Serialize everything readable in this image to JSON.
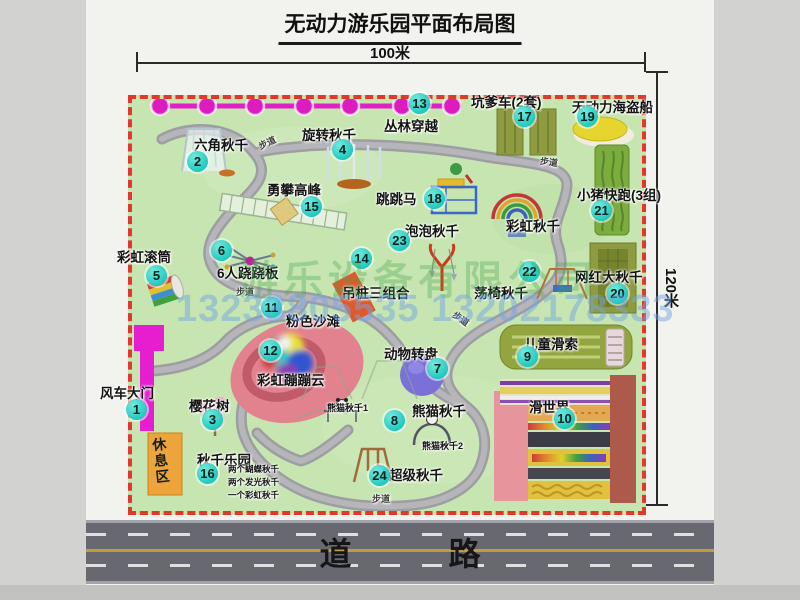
{
  "page": {
    "title": "无动力游乐园平面布局图"
  },
  "dimensions": {
    "top": "100米",
    "right": "120米"
  },
  "road": {
    "label": "道 路"
  },
  "watermark": {
    "company": "游乐设备有限公司",
    "phone": "13233805535 13202178333"
  },
  "map": {
    "rest_area_label": "休息区",
    "attractions": [
      {
        "num": "1",
        "name": "风车大门",
        "mx": 137,
        "my": 410,
        "lx": 100,
        "ly": 382
      },
      {
        "num": "2",
        "name": "六角秋千",
        "mx": 198,
        "my": 162,
        "lx": 194,
        "ly": 134
      },
      {
        "num": "3",
        "name": "樱花树",
        "mx": 213,
        "my": 420,
        "lx": 189,
        "ly": 395
      },
      {
        "num": "4",
        "name": "旋转秋千",
        "mx": 343,
        "my": 150,
        "lx": 302,
        "ly": 124
      },
      {
        "num": "5",
        "name": "彩虹滚筒",
        "mx": 157,
        "my": 276,
        "lx": 117,
        "ly": 246
      },
      {
        "num": "6",
        "name": "6人跷跷板",
        "mx": 222,
        "my": 251,
        "lx": 217,
        "ly": 262
      },
      {
        "num": "7",
        "name": "动物转盘",
        "mx": 438,
        "my": 369,
        "lx": 384,
        "ly": 343
      },
      {
        "num": "8",
        "name": "熊猫秋千",
        "mx": 395,
        "my": 421,
        "lx": 412,
        "ly": 400
      },
      {
        "num": "9",
        "name": "儿童滑索",
        "mx": 528,
        "my": 357,
        "lx": 524,
        "ly": 333
      },
      {
        "num": "10",
        "name": "滑世界",
        "mx": 565,
        "my": 419,
        "lx": 529,
        "ly": 396
      },
      {
        "num": "11",
        "name": "粉色沙滩",
        "mx": 272,
        "my": 308,
        "lx": 286,
        "ly": 310
      },
      {
        "num": "12",
        "name": "彩虹蹦蹦云",
        "mx": 271,
        "my": 351,
        "lx": 257,
        "ly": 369
      },
      {
        "num": "13",
        "name": "丛林穿越",
        "mx": 420,
        "my": 104,
        "lx": 384,
        "ly": 115
      },
      {
        "num": "14",
        "name": "吊桩三组合",
        "mx": 362,
        "my": 259,
        "lx": 342,
        "ly": 282
      },
      {
        "num": "15",
        "name": "勇攀高峰",
        "mx": 312,
        "my": 207,
        "lx": 267,
        "ly": 179
      },
      {
        "num": "16",
        "name": "秋千乐园",
        "mx": 208,
        "my": 474,
        "lx": 197,
        "ly": 449
      },
      {
        "num": "17",
        "name": "坑爹车(2套)",
        "mx": 525,
        "my": 117,
        "lx": 471,
        "ly": 91
      },
      {
        "num": "18",
        "name": "跳跳马",
        "mx": 435,
        "my": 199,
        "lx": 376,
        "ly": 188
      },
      {
        "num": "19",
        "name": "无动力海盗船",
        "mx": 588,
        "my": 117,
        "lx": 572,
        "ly": 96
      },
      {
        "num": "20",
        "name": "网红大秋千",
        "mx": 618,
        "my": 294,
        "lx": 575,
        "ly": 266
      },
      {
        "num": "21",
        "name": "小猪快跑(3组)",
        "mx": 602,
        "my": 211,
        "lx": 577,
        "ly": 184
      },
      {
        "num": "22",
        "name": "荡椅秋千",
        "mx": 530,
        "my": 272,
        "lx": 474,
        "ly": 282
      },
      {
        "num": "23",
        "name": "泡泡秋千",
        "mx": 400,
        "my": 241,
        "lx": 405,
        "ly": 220
      },
      {
        "num": "24",
        "name": "超级秋千",
        "mx": 380,
        "my": 476,
        "lx": 389,
        "ly": 464
      }
    ],
    "extra_labels": [
      {
        "text": "彩虹秋千",
        "x": 506,
        "y": 215,
        "cls": "",
        "rot": 0
      },
      {
        "text": "熊猫秋千1",
        "x": 327,
        "y": 401,
        "cls": "tiny",
        "rot": 0
      },
      {
        "text": "熊猫秋千2",
        "x": 422,
        "y": 439,
        "cls": "tiny",
        "rot": 0
      },
      {
        "text": "步道",
        "x": 258,
        "y": 136,
        "cls": "path-lab",
        "rot": -25
      },
      {
        "text": "步道",
        "x": 540,
        "y": 155,
        "cls": "path-lab",
        "rot": 8
      },
      {
        "text": "步道",
        "x": 236,
        "y": 285,
        "cls": "path-lab",
        "rot": 0
      },
      {
        "text": "步道",
        "x": 452,
        "y": 312,
        "cls": "path-lab",
        "rot": 35
      },
      {
        "text": "步道",
        "x": 372,
        "y": 492,
        "cls": "path-lab",
        "rot": 0
      },
      {
        "text": "两个蝴蝶秋千",
        "x": 228,
        "y": 463,
        "cls": "note",
        "rot": 0
      },
      {
        "text": "两个发光秋千",
        "x": 228,
        "y": 476,
        "cls": "note",
        "rot": 0
      },
      {
        "text": "一个彩虹秋千",
        "x": 228,
        "y": 489,
        "cls": "note",
        "rot": 0
      }
    ]
  }
}
